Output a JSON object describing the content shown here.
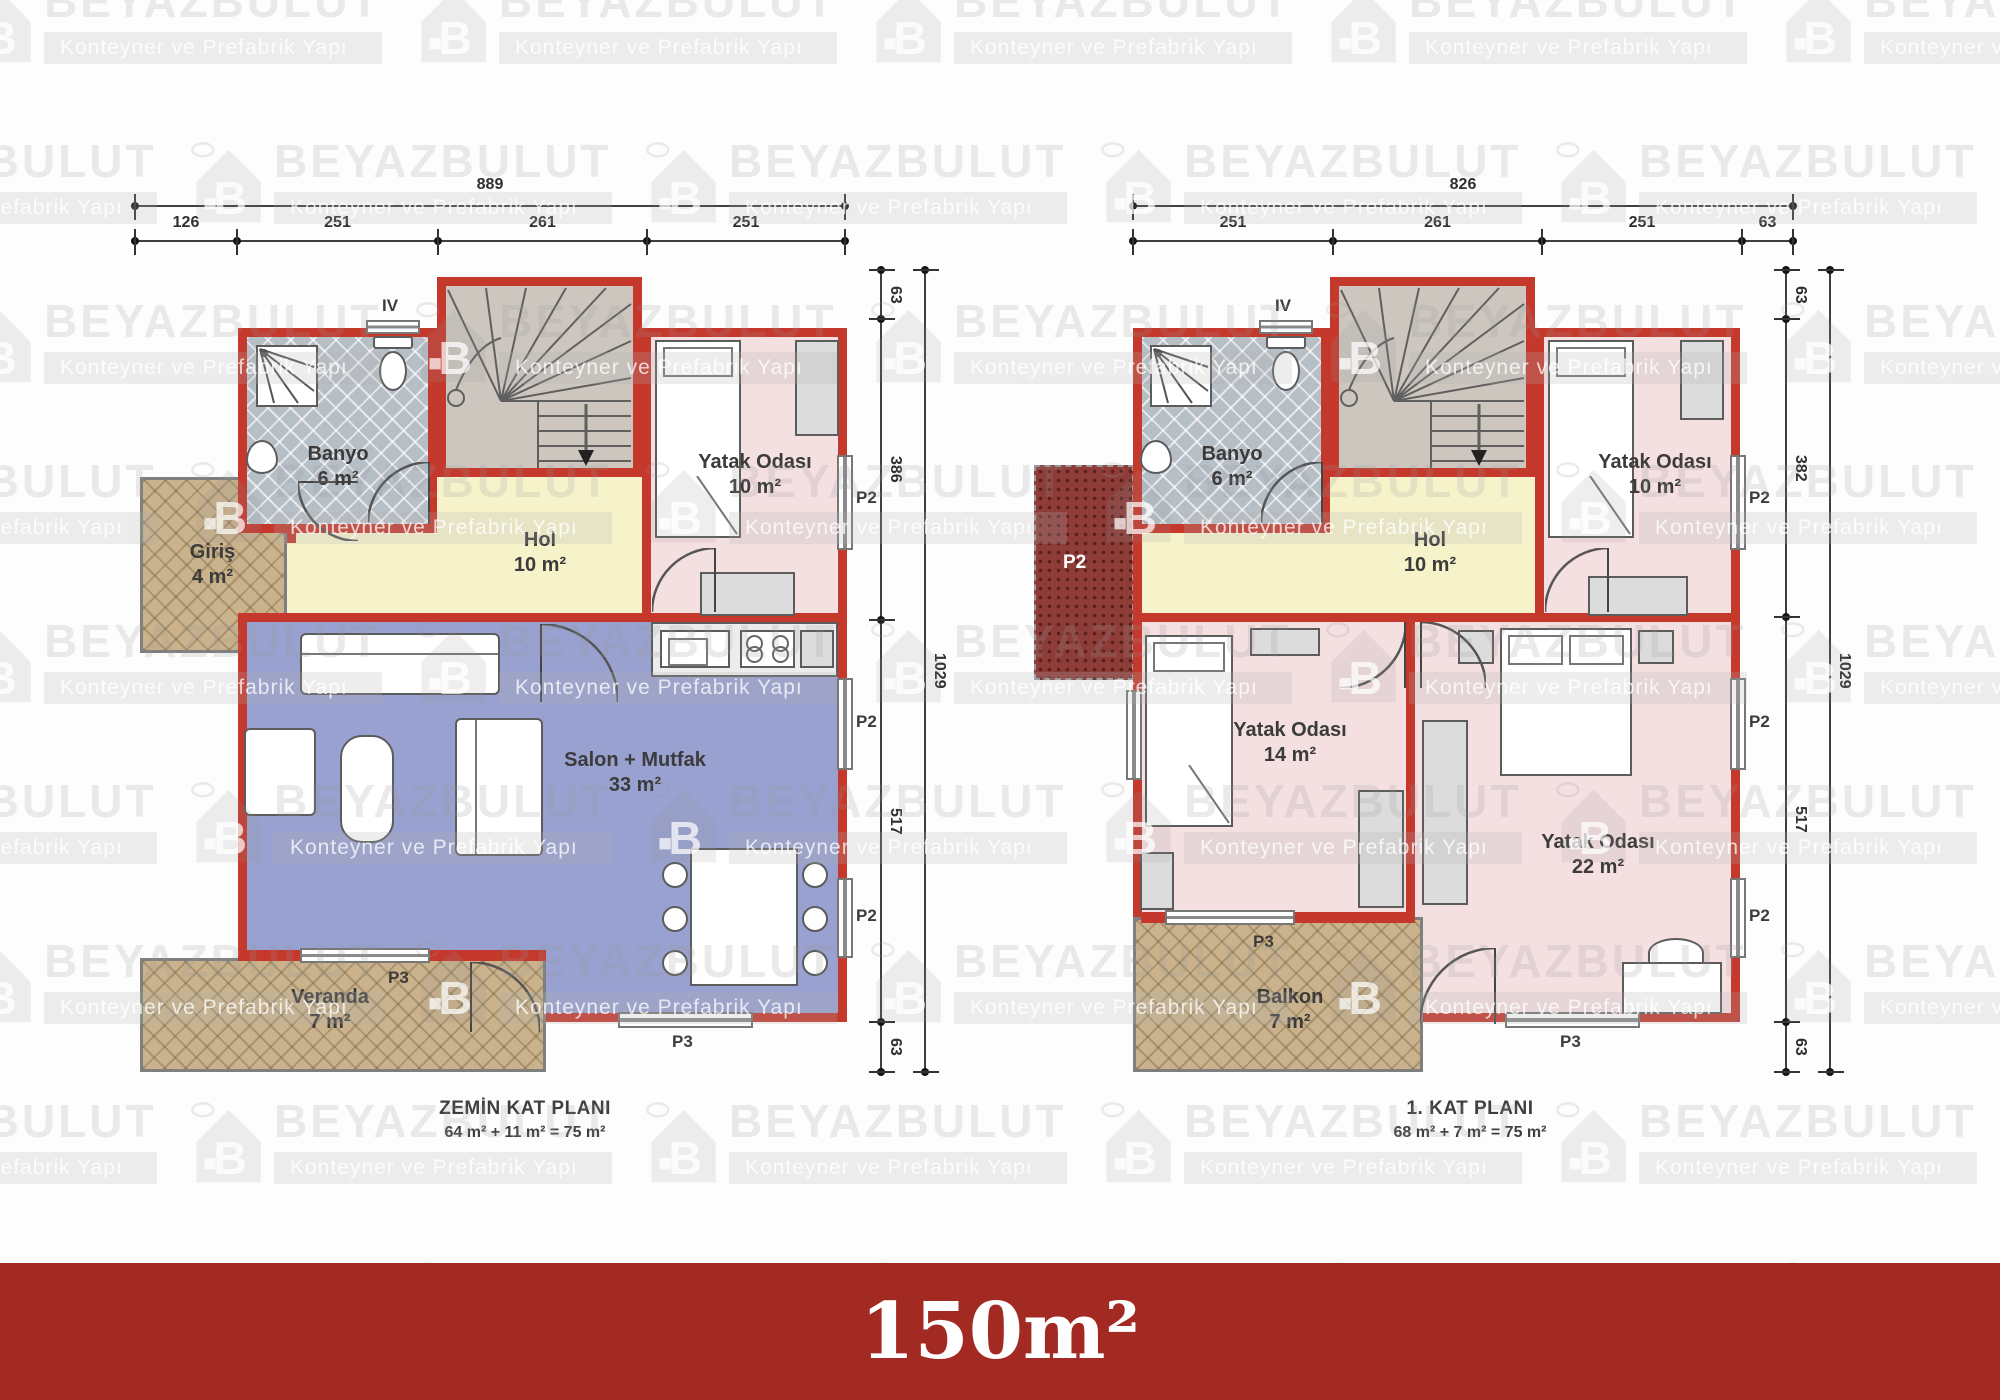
{
  "banner": {
    "text": "150m²",
    "bg": "#a32a23"
  },
  "watermark": {
    "brand": "BEYAZBULUT",
    "tagline": "Konteyner ve Prefabrik Yapı"
  },
  "labels": {
    "p2": "P2",
    "p3": "P3",
    "iv": "IV"
  },
  "colors": {
    "wall_red": "#c5382c",
    "banner_red": "#a32a23",
    "salon_blue": "#98a1cf",
    "hol_yellow": "#f6f3cb",
    "bedroom_pink": "#f4dfe1",
    "banyo_gray": "#b6bec6",
    "terrace_tan": "#c9b28c",
    "roof_dark_red": "#8d3c38",
    "stairs_gray": "#cdc6bf"
  },
  "plans": [
    {
      "title": "ZEMİN KAT PLANI",
      "subtitle": "64 m² + 11 m² = 75 m²",
      "dim_top_total": "889",
      "dims_top": [
        "126",
        "251",
        "261",
        "251"
      ],
      "dims_right": [
        "63",
        "386",
        "517",
        "63"
      ],
      "dim_right_total": "1029",
      "rooms": [
        {
          "name": "Banyo",
          "area": "6 m²"
        },
        {
          "name": "Giriş",
          "area": "4 m²"
        },
        {
          "name": "Hol",
          "area": "10 m²"
        },
        {
          "name": "Yatak Odası",
          "area": "10 m²"
        },
        {
          "name": "Salon + Mutfak",
          "area": "33 m²"
        },
        {
          "name": "Veranda",
          "area": "7 m²"
        }
      ]
    },
    {
      "title": "1. KAT PLANI",
      "subtitle": "68 m² + 7 m² = 75 m²",
      "dim_top_total": "826",
      "dims_top": [
        "251",
        "261",
        "251",
        "63"
      ],
      "dims_right": [
        "63",
        "382",
        "517",
        "63"
      ],
      "dim_right_total": "1029",
      "rooms": [
        {
          "name": "Banyo",
          "area": "6 m²"
        },
        {
          "name": "Hol",
          "area": "10 m²"
        },
        {
          "name": "Yatak Odası",
          "area": "10 m²"
        },
        {
          "name": "Yatak Odası",
          "area": "14 m²"
        },
        {
          "name": "Yatak Odası",
          "area": "22 m²"
        },
        {
          "name": "Balkon",
          "area": "7 m²"
        }
      ]
    }
  ]
}
